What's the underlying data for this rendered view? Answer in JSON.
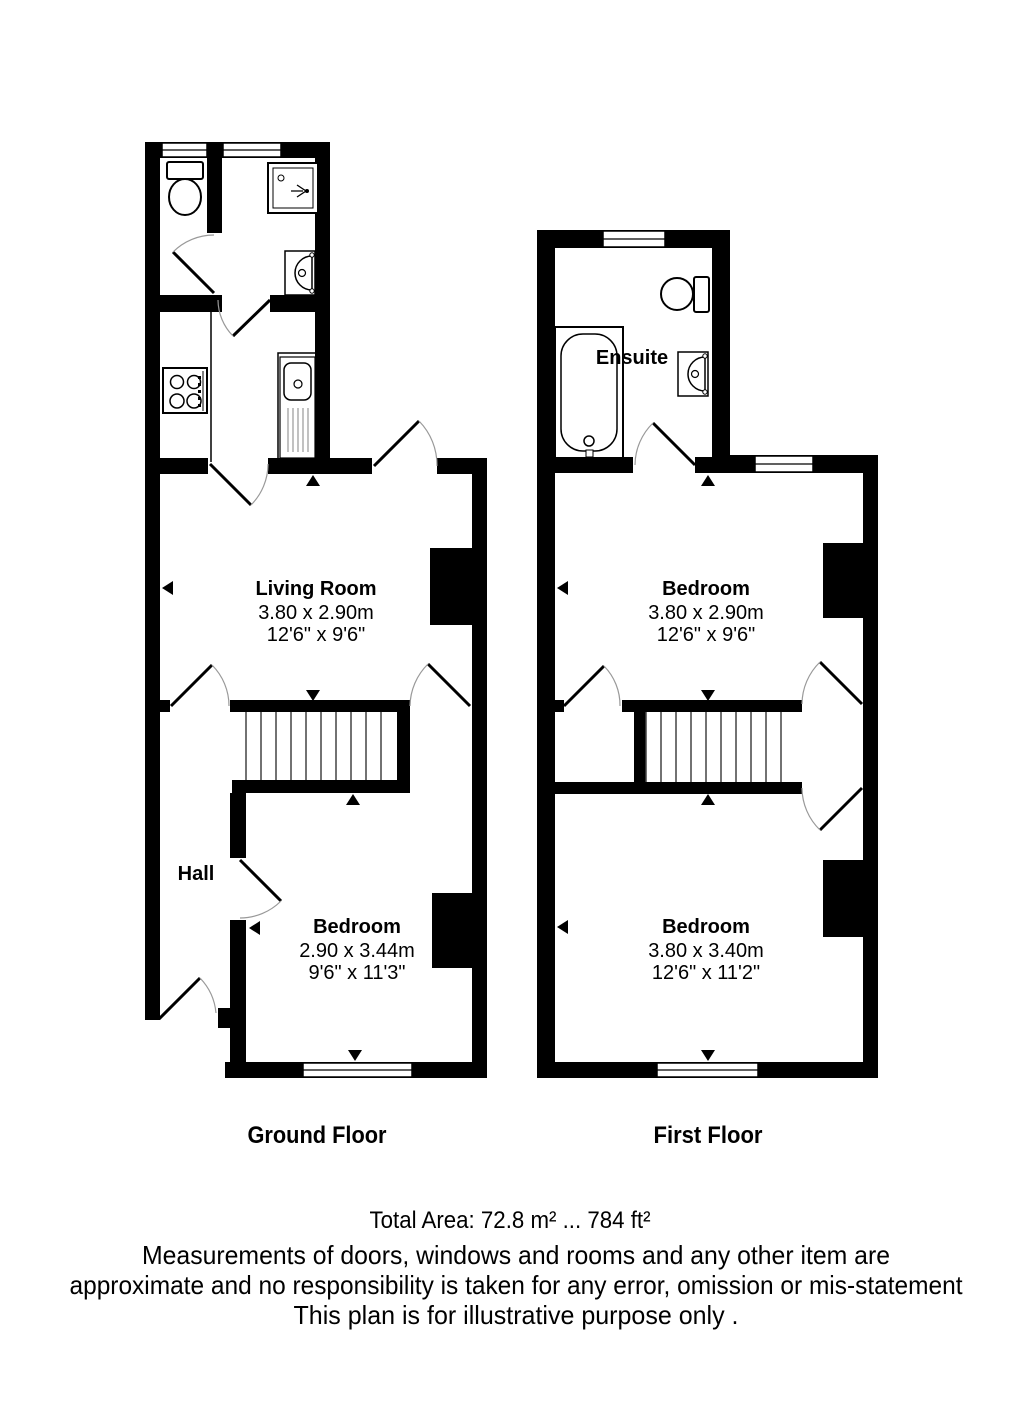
{
  "page": {
    "wall_color": "#000000",
    "floor_color": "#ffffff",
    "text_color": "#000000"
  },
  "ground_floor": {
    "title": "Ground Floor",
    "rooms": {
      "living_room": {
        "name": "Living Room",
        "size_metric": "3.80 x 2.90m",
        "size_imperial": "12'6\" x 9'6\""
      },
      "hall": {
        "name": "Hall"
      },
      "bedroom": {
        "name": "Bedroom",
        "size_metric": "2.90 x 3.44m",
        "size_imperial": "9'6\" x 11'3\""
      }
    },
    "fixtures": [
      "toilet",
      "shower",
      "basin",
      "hob",
      "sink",
      "stairs"
    ]
  },
  "first_floor": {
    "title": "First Floor",
    "rooms": {
      "ensuite": {
        "name": "Ensuite"
      },
      "bedroom_1": {
        "name": "Bedroom",
        "size_metric": "3.80 x 2.90m",
        "size_imperial": "12'6\" x 9'6\""
      },
      "bedroom_2": {
        "name": "Bedroom",
        "size_metric": "3.80 x 3.40m",
        "size_imperial": "12'6\" x 11'2\""
      }
    },
    "fixtures": [
      "bath",
      "toilet",
      "basin",
      "stairs"
    ]
  },
  "footer": {
    "total_area": "Total Area: 72.8 m² ... 784 ft²",
    "disclaimer": [
      "Measurements of doors, windows and rooms and any other item are",
      "approximate and no responsibility is taken for any error, omission or mis-statement",
      "This plan is for illustrative purpose only ."
    ]
  }
}
